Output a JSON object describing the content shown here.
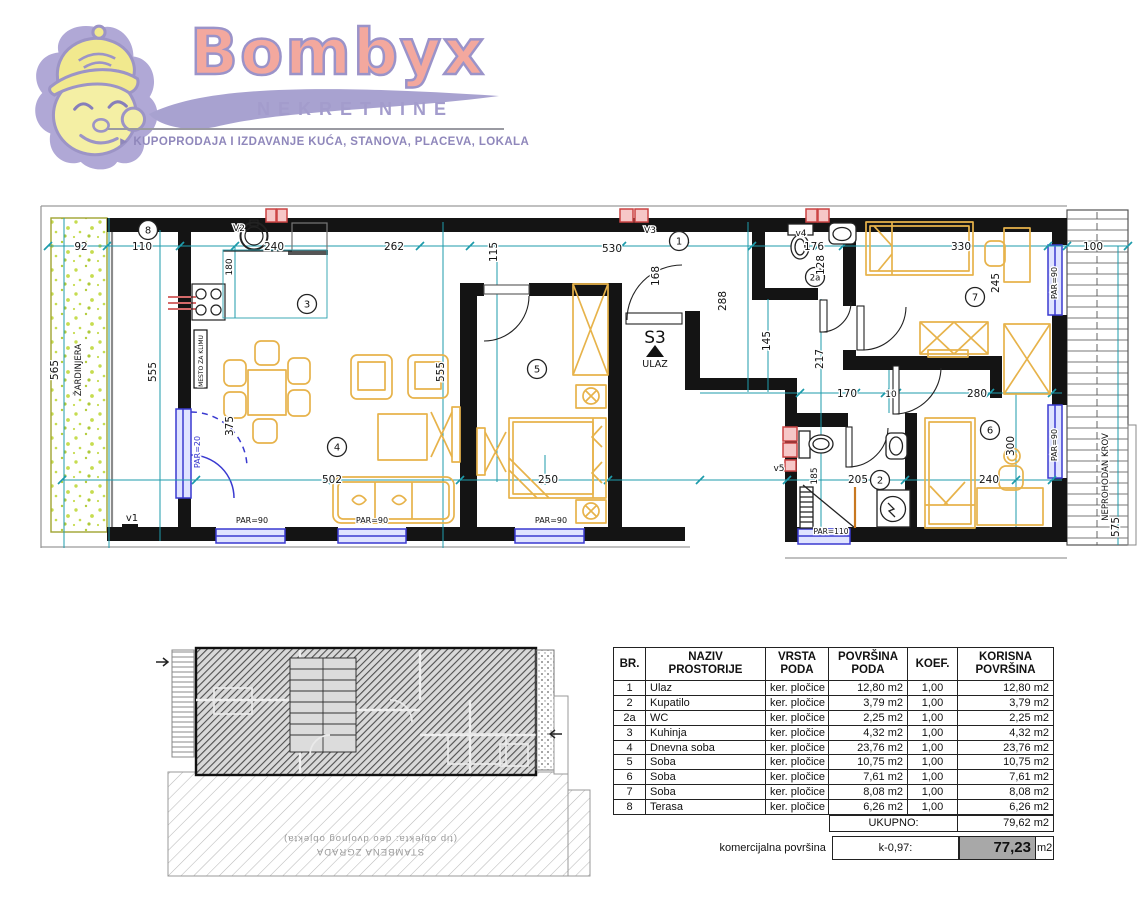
{
  "header": {
    "brand": "Bombyx",
    "subbrand": "NEKRETNINE",
    "tagline": "► KUPOPRODAJA I IZDAVANJE KUĆA, STANOVA, PLACEVA, LOKALA"
  },
  "colors": {
    "brand_fill": "#f3a89e",
    "brand_outline": "#9b93c9",
    "furniture": "#e7b34b",
    "dimension": "#1e9bab",
    "window": "#3a3ad0",
    "vent": "#cc4444",
    "wall": "#141414",
    "planter_green": "#c6dc50",
    "highlight_gray": "#a8a8a8"
  },
  "plan": {
    "unit_label": "S3",
    "entrance_label": "ULAZ",
    "circles": [
      {
        "t": "8",
        "x": 148,
        "y": 230
      },
      {
        "t": "3",
        "x": 307,
        "y": 304
      },
      {
        "t": "4",
        "x": 337,
        "y": 447
      },
      {
        "t": "5",
        "x": 537,
        "y": 369
      },
      {
        "t": "1",
        "x": 679,
        "y": 241
      },
      {
        "t": "2a",
        "x": 815,
        "y": 277
      },
      {
        "t": "7",
        "x": 975,
        "y": 297
      },
      {
        "t": "2",
        "x": 880,
        "y": 480
      },
      {
        "t": "6",
        "x": 990,
        "y": 430
      }
    ],
    "labels": [
      {
        "t": "92",
        "x": 81,
        "y": 250
      },
      {
        "t": "110",
        "x": 142,
        "y": 250
      },
      {
        "t": "240",
        "x": 274,
        "y": 250
      },
      {
        "t": "262",
        "x": 394,
        "y": 250
      },
      {
        "t": "530",
        "x": 612,
        "y": 252
      },
      {
        "t": "176",
        "x": 814,
        "y": 250
      },
      {
        "t": "330",
        "x": 961,
        "y": 250
      },
      {
        "t": "100",
        "x": 1093,
        "y": 250
      },
      {
        "t": "115",
        "x": 497,
        "y": 252,
        "r": -90
      },
      {
        "t": "168",
        "x": 659,
        "y": 276,
        "r": -90
      },
      {
        "t": "128",
        "x": 824,
        "y": 265,
        "r": -90
      },
      {
        "t": "565",
        "x": 58,
        "y": 370,
        "r": -90
      },
      {
        "t": "555",
        "x": 156,
        "y": 372,
        "r": -90
      },
      {
        "t": "555",
        "x": 444,
        "y": 372,
        "r": -90
      },
      {
        "t": "375",
        "x": 233,
        "y": 426,
        "r": -90
      },
      {
        "t": "180",
        "x": 232,
        "y": 267,
        "r": -90,
        "s": 9
      },
      {
        "t": "502",
        "x": 332,
        "y": 483
      },
      {
        "t": "250",
        "x": 548,
        "y": 483
      },
      {
        "t": "288",
        "x": 726,
        "y": 301,
        "r": -90
      },
      {
        "t": "145",
        "x": 770,
        "y": 341,
        "r": -90
      },
      {
        "t": "217",
        "x": 823,
        "y": 359,
        "r": -90
      },
      {
        "t": "170",
        "x": 847,
        "y": 397
      },
      {
        "t": "10",
        "x": 891,
        "y": 397,
        "s": 9
      },
      {
        "t": "280",
        "x": 977,
        "y": 397
      },
      {
        "t": "185",
        "x": 817,
        "y": 476,
        "r": -90,
        "s": 9
      },
      {
        "t": "205",
        "x": 858,
        "y": 483
      },
      {
        "t": "240",
        "x": 989,
        "y": 483
      },
      {
        "t": "300",
        "x": 1014,
        "y": 446,
        "r": -90
      },
      {
        "t": "245",
        "x": 999,
        "y": 283,
        "r": -90
      },
      {
        "t": "575",
        "x": 1119,
        "y": 527,
        "r": -90
      },
      {
        "t": "V2",
        "x": 239,
        "y": 231,
        "s": 9
      },
      {
        "t": "V3",
        "x": 650,
        "y": 233,
        "s": 9
      },
      {
        "t": "v4",
        "x": 801,
        "y": 236,
        "s": 9
      },
      {
        "t": "v5",
        "x": 779,
        "y": 471,
        "s": 9
      },
      {
        "t": "v1",
        "x": 132,
        "y": 521,
        "s": 10
      },
      {
        "t": "S3",
        "x": 655,
        "y": 343,
        "s": 17,
        "n": "unit-number-label"
      },
      {
        "t": "ULAZ",
        "x": 655,
        "y": 367,
        "s": 9.5,
        "n": "entrance-label"
      },
      {
        "t": "PAR=90",
        "x": 252,
        "y": 523,
        "s": 8
      },
      {
        "t": "PAR=90",
        "x": 372,
        "y": 523,
        "s": 8
      },
      {
        "t": "PAR=90",
        "x": 551,
        "y": 523,
        "s": 8
      },
      {
        "t": "PAR=90",
        "x": 1057,
        "y": 283,
        "r": -90,
        "s": 8
      },
      {
        "t": "PAR=90",
        "x": 1057,
        "y": 445,
        "r": -90,
        "s": 8
      },
      {
        "t": "PAR=110",
        "x": 831,
        "y": 534,
        "s": 7.5
      },
      {
        "t": "PAR=20",
        "x": 200,
        "y": 452,
        "r": -90,
        "s": 8,
        "c": "blue"
      },
      {
        "t": "ŽARDINJERA",
        "x": 81,
        "y": 370,
        "r": -90,
        "s": 8.5
      },
      {
        "t": "MESTO ZA KLIMU",
        "x": 203,
        "y": 361,
        "r": -90,
        "s": 6
      },
      {
        "t": "NEPROHODAN KROV",
        "x": 1108,
        "y": 477,
        "r": -90,
        "s": 8.5
      }
    ]
  },
  "siteplan": {
    "caption_line1": "STAMBENA ZGRADA",
    "caption_line2": "(tip objekta: deo dvojnog objekta)"
  },
  "table": {
    "headers": {
      "br": "BR.",
      "name1": "NAZIV",
      "name2": "PROSTORIJE",
      "floor1": "VRSTA",
      "floor2": "PODA",
      "area1": "POVRŠINA",
      "area2": "PODA",
      "koef": "KOEF.",
      "usable1": "KORISNA",
      "usable2": "POVRŠINA"
    },
    "unit": "m2",
    "rows": [
      {
        "br": "1",
        "name": "Ulaz",
        "floor": "ker. pločice",
        "area": "12,80",
        "koef": "1,00",
        "usable": "12,80"
      },
      {
        "br": "2",
        "name": "Kupatilo",
        "floor": "ker. pločice",
        "area": "3,79",
        "koef": "1,00",
        "usable": "3,79"
      },
      {
        "br": "2a",
        "name": "WC",
        "floor": "ker. pločice",
        "area": "2,25",
        "koef": "1,00",
        "usable": "2,25"
      },
      {
        "br": "3",
        "name": "Kuhinja",
        "floor": "ker. pločice",
        "area": "4,32",
        "koef": "1,00",
        "usable": "4,32"
      },
      {
        "br": "4",
        "name": "Dnevna soba",
        "floor": "ker. pločice",
        "area": "23,76",
        "koef": "1,00",
        "usable": "23,76"
      },
      {
        "br": "5",
        "name": "Soba",
        "floor": "ker. pločice",
        "area": "10,75",
        "koef": "1,00",
        "usable": "10,75"
      },
      {
        "br": "6",
        "name": "Soba",
        "floor": "ker. pločice",
        "area": "7,61",
        "koef": "1,00",
        "usable": "7,61"
      },
      {
        "br": "7",
        "name": "Soba",
        "floor": "ker. pločice",
        "area": "8,08",
        "koef": "1,00",
        "usable": "8,08"
      },
      {
        "br": "8",
        "name": "Terasa",
        "floor": "ker. pločice",
        "area": "6,26",
        "koef": "1,00",
        "usable": "6,26"
      }
    ],
    "total_label": "UKUPNO:",
    "total_value": "79,62",
    "commercial_label": "komercijalna površina",
    "coef_label": "k-0,97:",
    "commercial_value": "77,23"
  }
}
